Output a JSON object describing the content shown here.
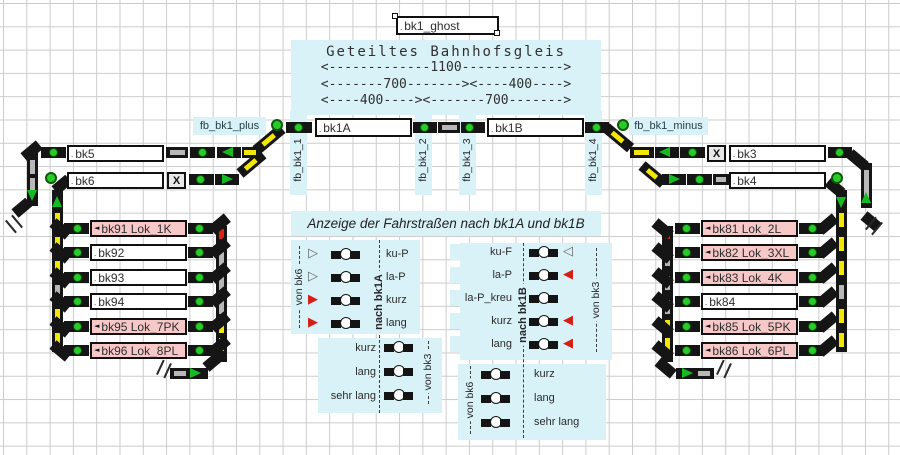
{
  "ghost": {
    "label": "bk1_ghost"
  },
  "gleis": {
    "title": "Geteiltes Bahnhofsgleis",
    "dim_total": "<-------------1100------------->",
    "dim_split1": "<-------700-------><----400---->",
    "dim_split2": "<----400----><-------700------->"
  },
  "main": {
    "bk1a": "bk1A",
    "bk1b": "bk1B",
    "fb_plus": "fb_bk1_plus",
    "fb_minus": "fb_bk1_minus",
    "fb1": "fb_bk1_1",
    "fb2": "fb_bk1_2",
    "fb3": "fb_bk1_3",
    "fb4": "fb_bk1_4"
  },
  "left_station": {
    "bk5": "bk5",
    "bk6": "bk6",
    "release": "X"
  },
  "right_station": {
    "bk3": "bk3",
    "bk4": "bk4",
    "release": "X"
  },
  "left_yard": {
    "rows": [
      {
        "label": "bk91 Lok_1K",
        "state": "occupied"
      },
      {
        "label": "bk92",
        "state": "free"
      },
      {
        "label": "bk93",
        "state": "free"
      },
      {
        "label": "bk94",
        "state": "free"
      },
      {
        "label": "bk95 Lok_7PK",
        "state": "occupied"
      },
      {
        "label": "bk96 Lok_8PL",
        "state": "occupied"
      }
    ]
  },
  "right_yard": {
    "rows": [
      {
        "label": "bk81 Lok_2L",
        "state": "occupied"
      },
      {
        "label": "bk82 Lok_3XL",
        "state": "occupied"
      },
      {
        "label": "bk83 Lok_4K",
        "state": "occupied"
      },
      {
        "label": "bk84",
        "state": "free"
      },
      {
        "label": "bk85 Lok_5PK",
        "state": "occupied"
      },
      {
        "label": "bk86 Lok_6PL",
        "state": "occupied"
      }
    ]
  },
  "routes": {
    "title": "Anzeige der Fahrstraßen nach bk1A und bk1B",
    "left": {
      "from": "von bk6",
      "to": "nach bk1A",
      "from2": "von bk3",
      "rows": [
        {
          "label": "ku-P",
          "glyph": "▷",
          "state": "free"
        },
        {
          "label": "la-P",
          "glyph": "▷",
          "state": "free"
        },
        {
          "label": "kurz",
          "glyph": "▶",
          "state": "set"
        },
        {
          "label": "lang",
          "glyph": "▶",
          "state": "set"
        }
      ],
      "rows2": [
        {
          "label": "kurz"
        },
        {
          "label": "lang"
        },
        {
          "label": "sehr lang"
        }
      ]
    },
    "right": {
      "from": "von bk3",
      "to": "nach bk1B",
      "from2": "von bk6",
      "rows": [
        {
          "label": "ku-F",
          "glyph": "◁",
          "state": "free"
        },
        {
          "label": "la-P",
          "glyph": "◀",
          "state": "set"
        },
        {
          "label": "la-P_kreu",
          "glyph": "",
          "state": "none"
        },
        {
          "label": "kurz",
          "glyph": "◀",
          "state": "set"
        },
        {
          "label": "lang",
          "glyph": "◀",
          "state": "set"
        }
      ],
      "rows2": [
        {
          "label": "kurz"
        },
        {
          "label": "lang"
        },
        {
          "label": "sehr lang"
        }
      ]
    }
  },
  "markers": {
    "occupied": "◄",
    "free": "."
  },
  "colors": {
    "panel_cyan": "#d9f2f7",
    "occupied_pink": "#f6c8c8",
    "route_set_red": "#d61f14",
    "signal_green": "#14bc22",
    "turnout_yellow": "#f2e800"
  }
}
